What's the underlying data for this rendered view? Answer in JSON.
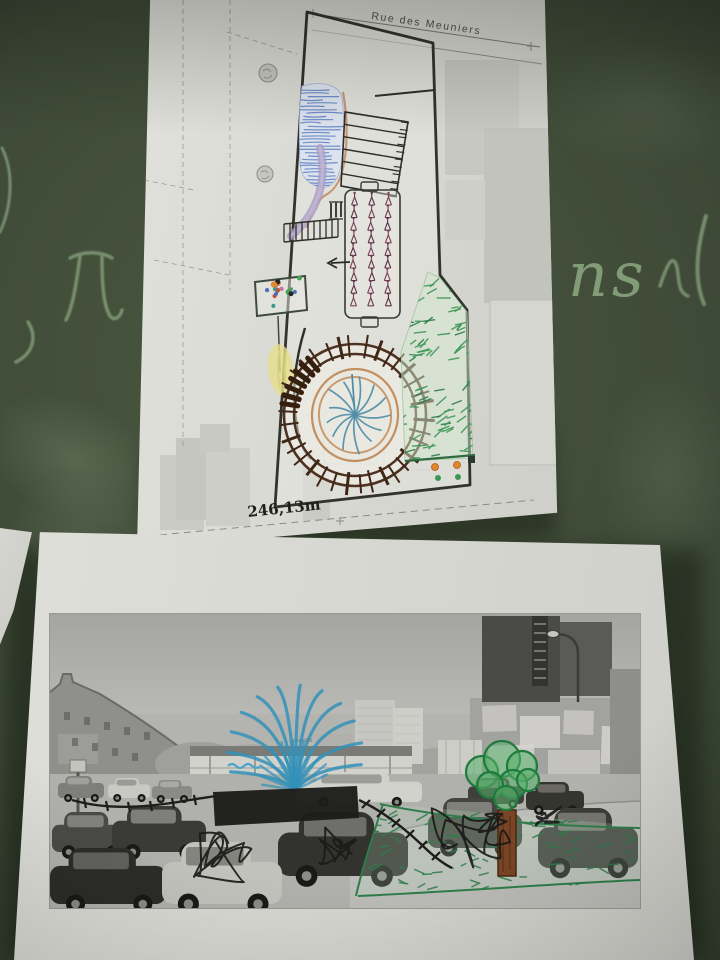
{
  "scene": {
    "description": "Photograph of a dark green chalkboard with two taped sheets: a hand-annotated cadastral site plan above and a hand-annotated black-and-white street photo below",
    "board_color": "#3c4837",
    "chalk_color": "#b7dcab",
    "chalk_fragment_text": "ns"
  },
  "map_sheet": {
    "street_label_top": "Rue des Meuniers",
    "street_label_bottom": "Marguerite",
    "length_label": "246,13m",
    "paper_color": "#d8d8d2",
    "features": {
      "plot_boundary_color": "#33332e",
      "water_blue": "#5b7fc0",
      "path_purple": "#a89cc2",
      "stair_black": "#2e2e2a",
      "edge_tan": "#c08a62",
      "planting_glyph_color": "#6b3a4e",
      "flower_dot_colors": [
        "#4aa055",
        "#4a6fc0",
        "#e08830",
        "#26262a",
        "#cf74a2",
        "#c04a3a",
        "#3a9a8a"
      ],
      "yellow_patch": "#e6df8e",
      "spiral_ring_brown": "#4e3120",
      "spiral_tick_brown": "#3f2718",
      "spiral_inner_tan": "#c28f60",
      "center_star_blue": "#4e8ca6",
      "grass_green": "#3f9757",
      "grass_green_dark": "#2f7d47",
      "dot_orange": "#e08830",
      "dot_green": "#3f9757"
    }
  },
  "photo_sheet": {
    "paper_color": "#d8d8d2",
    "photo_grays": {
      "sky": "#aaaaa6",
      "ground": "#b0b0ac",
      "dark_cars": "#32322e"
    },
    "marker_colors": {
      "blue": "#3391b8",
      "green": "#2f7d4a",
      "black": "#1c1c1a",
      "trunk_brown": "#7a4526",
      "leaf_green": "#58b06a"
    }
  }
}
